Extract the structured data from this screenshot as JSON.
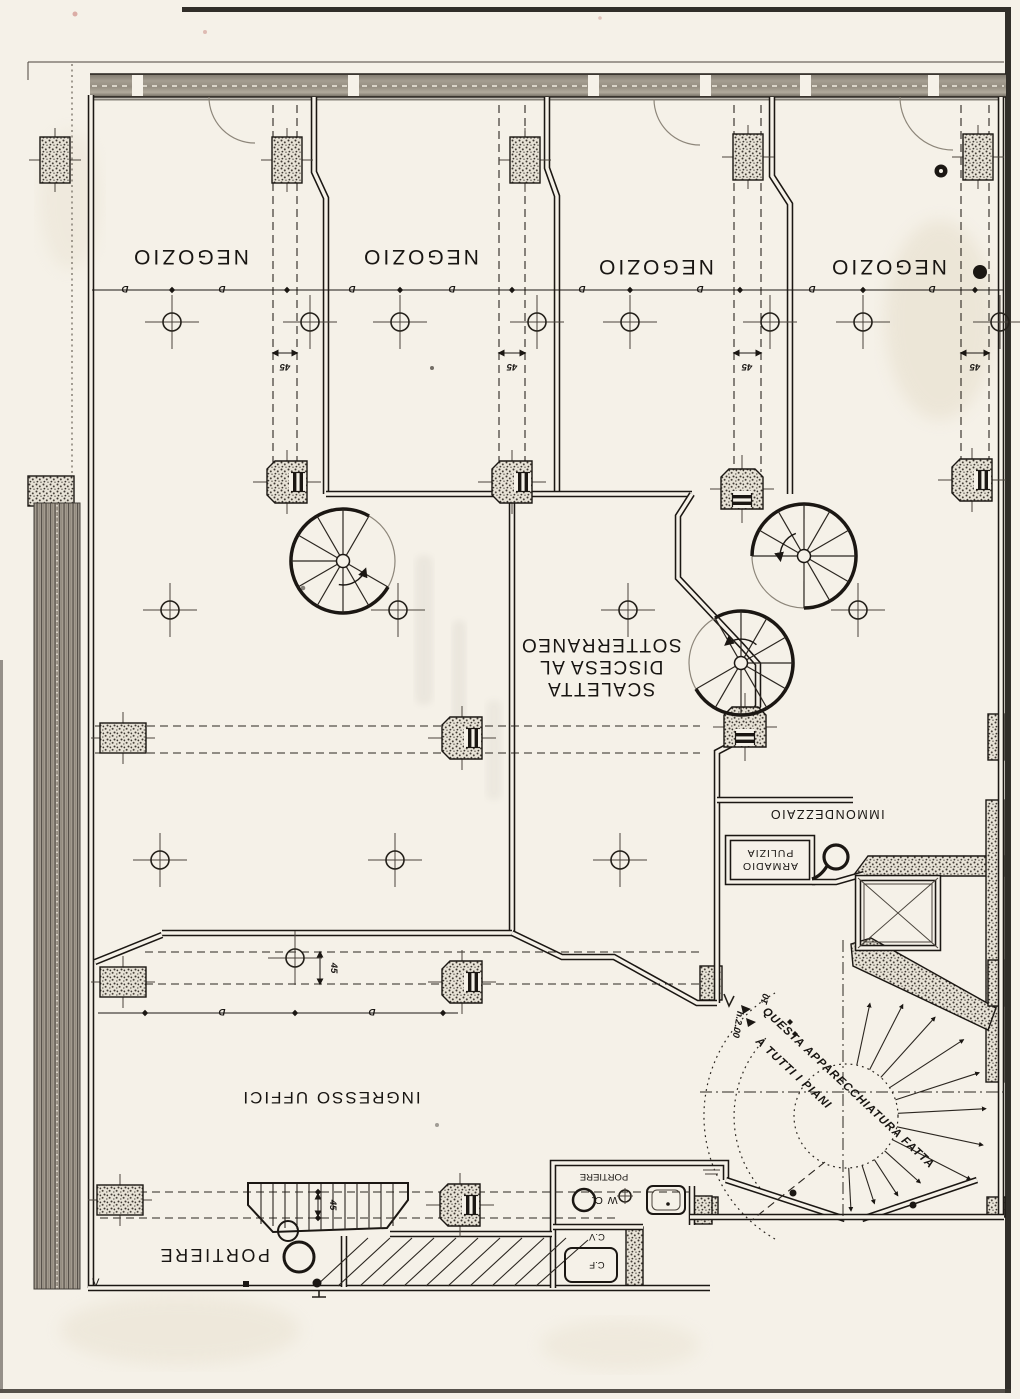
{
  "plan": {
    "rooms": {
      "negozio": "NEGOZIO",
      "scaletta_line1": "SCALETTA",
      "scaletta_line2": "DISCESA AL",
      "scaletta_line3": "SOTTERRANEO",
      "ingresso_uffici": "INGRESSO UFFICI",
      "portiere": "PORTIERE",
      "immondezzaio": "IMMONDEZZAIO",
      "armadio_line1": "ARMADIO",
      "armadio_line2": "PULIZIA",
      "wc_portiere": "PORTIERE",
      "wc": "W C.",
      "cf": "C.F",
      "cv": "C.V"
    },
    "annotations": {
      "note_line1": "QUESTA APPARECCHIATURA FATTA",
      "note_line2": "A TUTTI I PIANI",
      "height_note": "h.2.00",
      "dim_45": "45",
      "dim_10": "10",
      "dim_d": "D",
      "v_mark": "V"
    },
    "colors": {
      "paper": "#f5f1e8",
      "ink": "#1b1713"
    }
  }
}
